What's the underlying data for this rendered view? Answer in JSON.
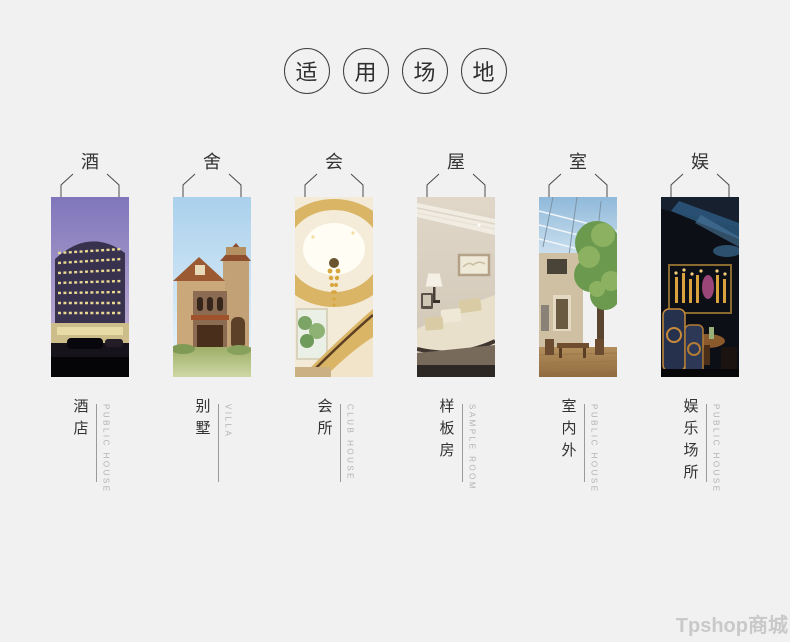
{
  "page": {
    "background_color": "#f1f1f1",
    "text_color": "#333333",
    "muted_text_color": "#b2b2b2",
    "watermark": "Tpshop商城",
    "watermark_color": "#c9c9c9"
  },
  "header": {
    "chars": [
      "适",
      "用",
      "场",
      "地"
    ],
    "title": "适用场地"
  },
  "venues": [
    {
      "tag": "酒",
      "zh": "酒店",
      "en": "PUBLIC HOUSE",
      "photo": "hotel-photo"
    },
    {
      "tag": "舍",
      "zh": "别墅",
      "en": "VILLA",
      "photo": "villa-photo"
    },
    {
      "tag": "会",
      "zh": "会所",
      "en": "CLUB HOUSE",
      "photo": "club-house-photo"
    },
    {
      "tag": "屋",
      "zh": "样板房",
      "en": "SAMPLE ROOM",
      "photo": "sample-room-photo"
    },
    {
      "tag": "室",
      "zh": "室内外",
      "en": "PUBLIC HOUSE",
      "photo": "indoor-outdoor-photo"
    },
    {
      "tag": "娱",
      "zh": "娱乐场所",
      "en": "PUBLIC HOUSE",
      "photo": "entertainment-photo"
    }
  ]
}
